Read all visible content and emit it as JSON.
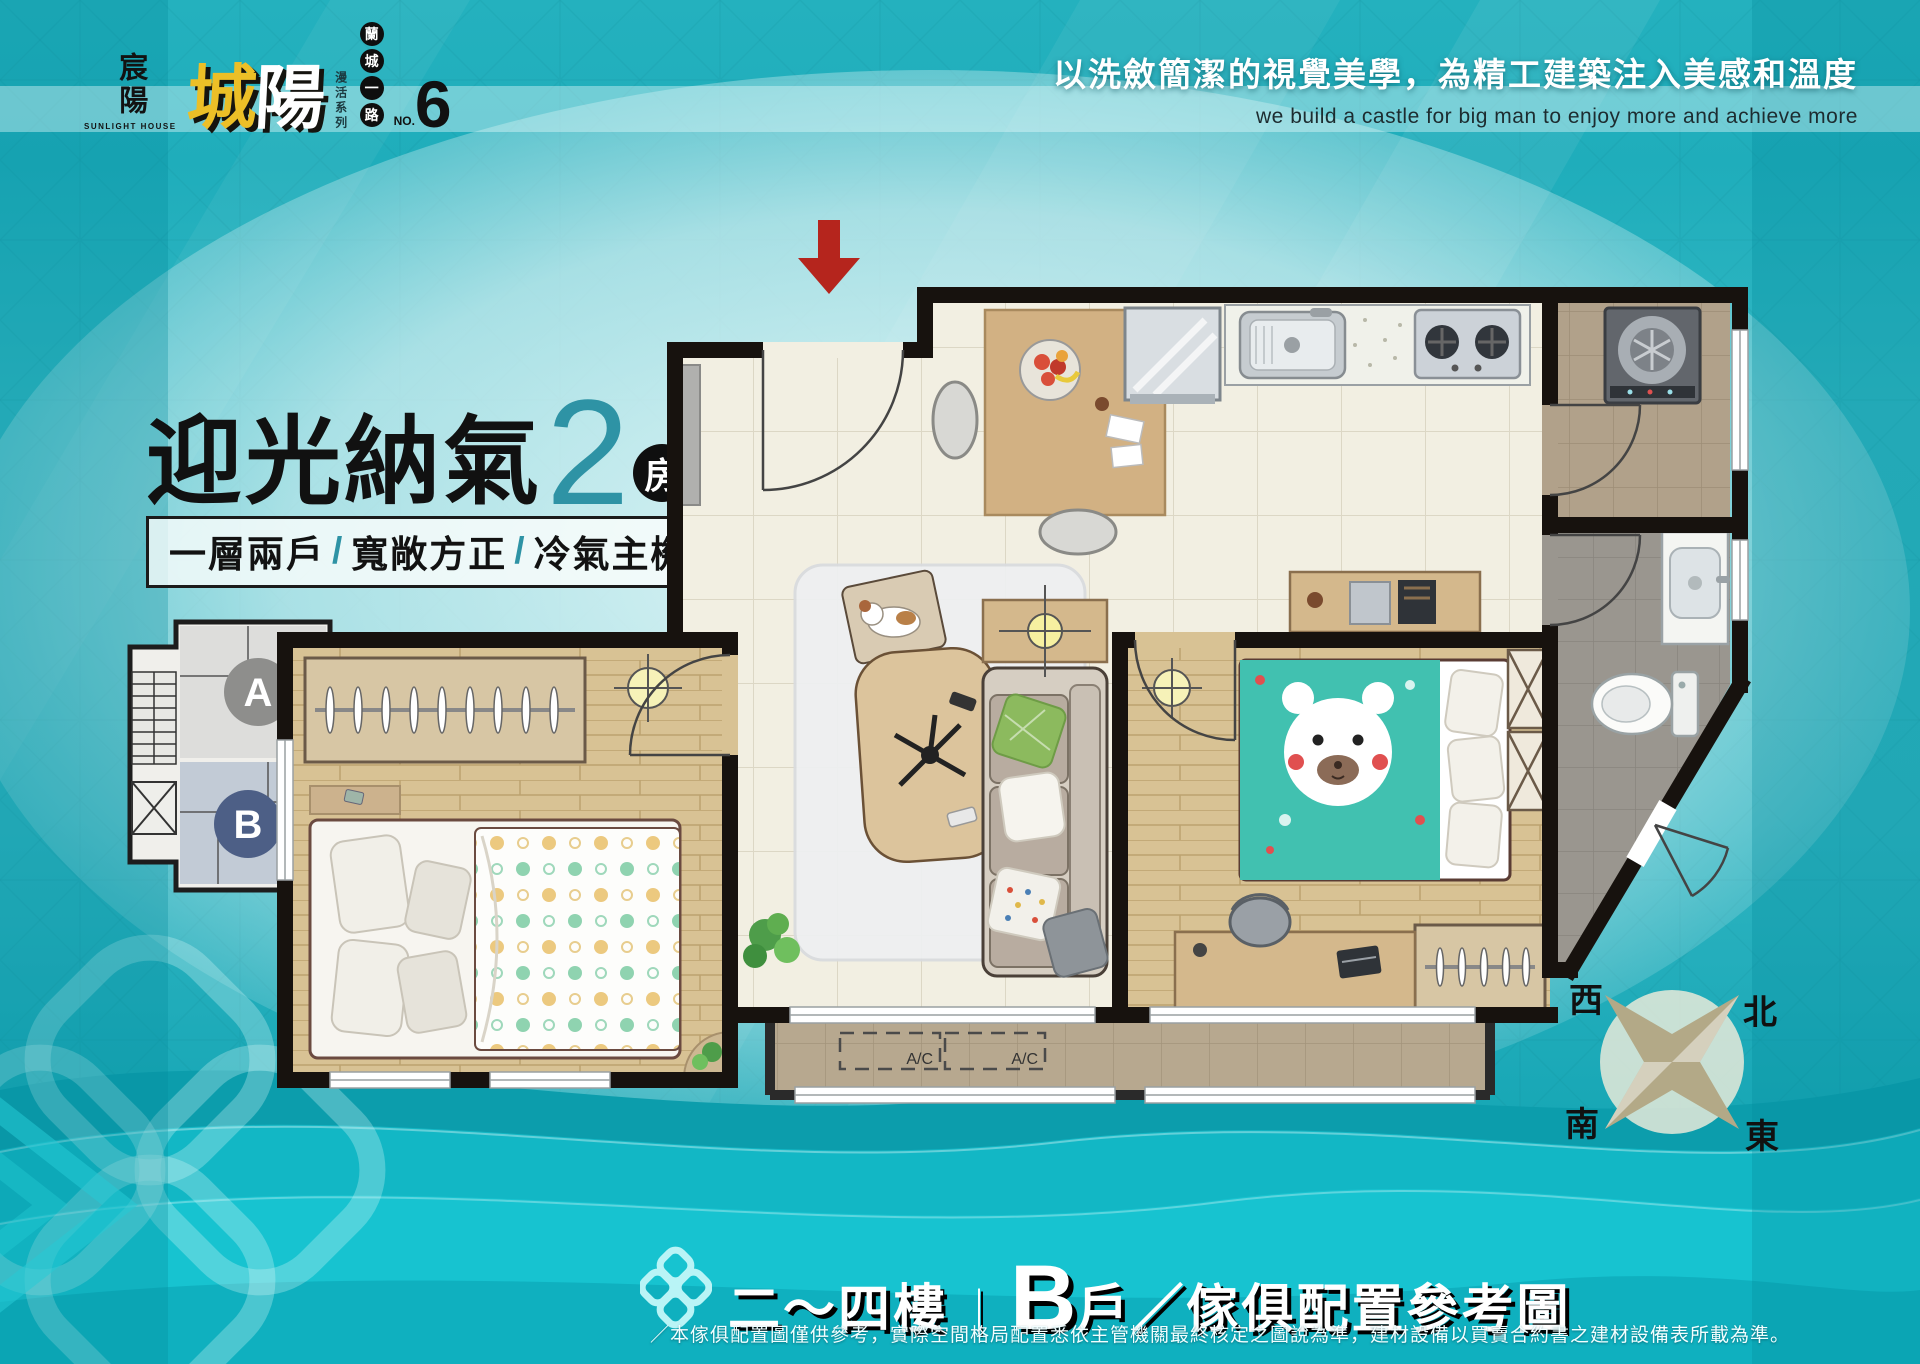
{
  "logo": {
    "vertical_name": "宸陽",
    "vertical_sub": "SUNLIGHT HOUSE",
    "main_char_1": "城",
    "main_char_2": "陽",
    "series": "漫活系列",
    "road_badges": [
      "蘭",
      "城",
      "一",
      "路"
    ],
    "no_prefix": "NO.",
    "no_value": "6"
  },
  "tagline": {
    "zh": "以洗斂簡潔的視覺美學，為精工建築注入美感和溫度",
    "en": "we build a castle for big man to enjoy more and achieve more"
  },
  "headline": {
    "title": "迎光納氣",
    "count_rooms": "2",
    "rooms_unit": "房",
    "count_halls": "2",
    "halls_unit": "廳",
    "sep": "/",
    "features": [
      "一層兩戶",
      "寬敞方正",
      "冷氣主機"
    ]
  },
  "keyplan": {
    "unit_a": "A",
    "unit_b": "B"
  },
  "plan": {
    "ac_label_1": "A/C",
    "ac_label_2": "A/C"
  },
  "compass": {
    "west": "西",
    "north": "北",
    "south": "南",
    "east": "東"
  },
  "footer": {
    "floors": "二～四樓",
    "bar": "｜",
    "unit_big": "B",
    "unit_suffix": "戶",
    "slash": "／",
    "title": "傢俱配置參考圖",
    "disclaimer": "／本傢俱配置圖僅供參考，實際空間格局配置悉依主管機關最終核定之圖說為準，建材設備以買賣合約書之建材設備表所載為準。"
  },
  "colors": {
    "teal_bg": "#1fadbb",
    "accent_teal": "#2e93a5",
    "arrow_red": "#b5251d",
    "wave_bright": "#17c3d0",
    "gold": "#ecbf27"
  }
}
